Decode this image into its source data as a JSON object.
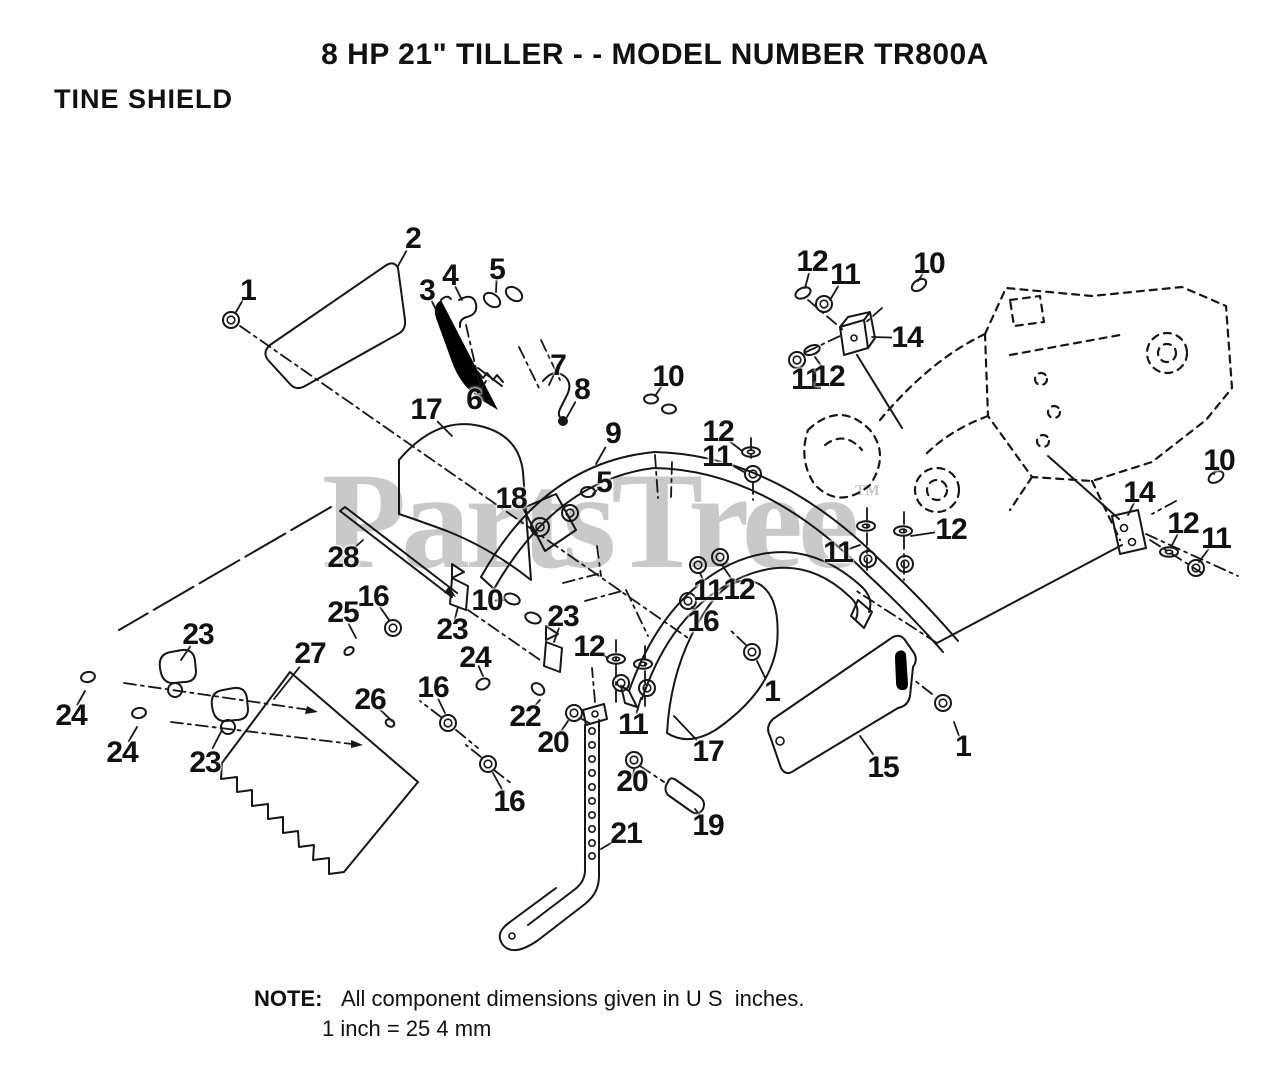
{
  "page": {
    "title": "8 HP 21\" TILLER - - MODEL NUMBER TR800A",
    "section": "TINE SHIELD",
    "note": {
      "label": "NOTE:",
      "line1": "All component dimensions given in U S  inches.",
      "line2": "1 inch = 25 4 mm"
    },
    "watermark": {
      "text": "PartsTree",
      "tm": "™",
      "color": "#c9c9c9"
    }
  },
  "diagram": {
    "ink": "#161616",
    "description": "Exploded parts view of tine shield assembly with numbered callouts",
    "callouts": [
      {
        "label": "1",
        "x": 248,
        "y": 291,
        "tx": 236,
        "ty": 312
      },
      {
        "label": "2",
        "x": 413,
        "y": 239,
        "tx": 398,
        "ty": 266
      },
      {
        "label": "3",
        "x": 427,
        "y": 291,
        "tx": 438,
        "ty": 314
      },
      {
        "label": "4",
        "x": 450,
        "y": 276,
        "tx": 462,
        "ty": 300
      },
      {
        "label": "5",
        "x": 497,
        "y": 270,
        "tx": 496,
        "ty": 292
      },
      {
        "label": "6",
        "x": 474,
        "y": 400,
        "tx": 486,
        "ty": 381
      },
      {
        "label": "7",
        "x": 558,
        "y": 366,
        "tx": 549,
        "ty": 385
      },
      {
        "label": "8",
        "x": 582,
        "y": 390,
        "tx": 567,
        "ty": 417
      },
      {
        "label": "9",
        "x": 613,
        "y": 434,
        "tx": 596,
        "ty": 464
      },
      {
        "label": "10",
        "x": 668,
        "y": 377,
        "tx": 655,
        "ty": 396
      },
      {
        "label": "12",
        "x": 718,
        "y": 432,
        "tx": 742,
        "ty": 451
      },
      {
        "label": "11",
        "x": 717,
        "y": 457,
        "tx": 744,
        "ty": 472
      },
      {
        "label": "18",
        "x": 511,
        "y": 499,
        "tx": 528,
        "ty": 513
      },
      {
        "label": "5",
        "x": 604,
        "y": 483,
        "tx": 593,
        "ty": 494
      },
      {
        "label": "28",
        "x": 343,
        "y": 558,
        "tx": 363,
        "ty": 540
      },
      {
        "label": "12",
        "x": 812,
        "y": 262,
        "tx": 805,
        "ty": 288
      },
      {
        "label": "11",
        "x": 845,
        "y": 275,
        "tx": 830,
        "ty": 300
      },
      {
        "label": "10",
        "x": 929,
        "y": 264,
        "tx": 918,
        "ty": 281
      },
      {
        "label": "14",
        "x": 907,
        "y": 338,
        "tx": 872,
        "ty": 337
      },
      {
        "label": "11",
        "x": 806,
        "y": 380,
        "tx": 798,
        "ty": 368
      },
      {
        "label": "12",
        "x": 829,
        "y": 377,
        "tx": 815,
        "ty": 357
      },
      {
        "label": "10",
        "x": 1219,
        "y": 461,
        "tx": 1214,
        "ty": 474
      },
      {
        "label": "14",
        "x": 1139,
        "y": 493,
        "tx": 1128,
        "ty": 515
      },
      {
        "label": "12",
        "x": 1183,
        "y": 524,
        "tx": 1171,
        "ty": 547
      },
      {
        "label": "11",
        "x": 1216,
        "y": 539,
        "tx": 1199,
        "ty": 562
      },
      {
        "label": "12",
        "x": 951,
        "y": 530,
        "tx": 911,
        "ty": 536
      },
      {
        "label": "11",
        "x": 838,
        "y": 553,
        "tx": 860,
        "ty": 545
      },
      {
        "label": "11",
        "x": 708,
        "y": 591,
        "tx": 700,
        "ty": 573
      },
      {
        "label": "12",
        "x": 739,
        "y": 590,
        "tx": 722,
        "ty": 565
      },
      {
        "label": "16",
        "x": 703,
        "y": 622,
        "tx": 692,
        "ty": 607
      },
      {
        "label": "1",
        "x": 772,
        "y": 692,
        "tx": 757,
        "ty": 661
      },
      {
        "label": "17",
        "x": 708,
        "y": 752,
        "tx": 674,
        "ty": 716
      },
      {
        "label": "15",
        "x": 883,
        "y": 768,
        "tx": 860,
        "ty": 736
      },
      {
        "label": "1",
        "x": 963,
        "y": 747,
        "tx": 954,
        "ty": 722
      },
      {
        "label": "16",
        "x": 373,
        "y": 597,
        "tx": 389,
        "ty": 620
      },
      {
        "label": "25",
        "x": 343,
        "y": 613,
        "tx": 356,
        "ty": 638
      },
      {
        "label": "23",
        "x": 452,
        "y": 630,
        "tx": 458,
        "ty": 607
      },
      {
        "label": "10",
        "x": 487,
        "y": 601,
        "tx": 506,
        "ty": 600
      },
      {
        "label": "23",
        "x": 563,
        "y": 617,
        "tx": 554,
        "ty": 642
      },
      {
        "label": "12",
        "x": 589,
        "y": 647,
        "tx": 608,
        "ty": 658
      },
      {
        "label": "24",
        "x": 475,
        "y": 658,
        "tx": 483,
        "ty": 676
      },
      {
        "label": "26",
        "x": 370,
        "y": 700,
        "tx": 392,
        "ty": 721
      },
      {
        "label": "16",
        "x": 433,
        "y": 688,
        "tx": 445,
        "ty": 713
      },
      {
        "label": "22",
        "x": 525,
        "y": 717,
        "tx": 540,
        "ty": 700
      },
      {
        "label": "20",
        "x": 553,
        "y": 743,
        "tx": 568,
        "ty": 721
      },
      {
        "label": "11",
        "x": 633,
        "y": 725,
        "tx": 641,
        "ty": 698
      },
      {
        "label": "20",
        "x": 632,
        "y": 782,
        "tx": 634,
        "ty": 769
      },
      {
        "label": "16",
        "x": 509,
        "y": 802,
        "tx": 493,
        "ty": 773
      },
      {
        "label": "21",
        "x": 626,
        "y": 834,
        "tx": 601,
        "ty": 849
      },
      {
        "label": "19",
        "x": 708,
        "y": 826,
        "tx": 695,
        "ty": 809
      },
      {
        "label": "17",
        "x": 426,
        "y": 410,
        "tx": 452,
        "ty": 436
      },
      {
        "label": "23",
        "x": 198,
        "y": 635,
        "tx": 181,
        "ty": 660
      },
      {
        "label": "24",
        "x": 71,
        "y": 716,
        "tx": 85,
        "ty": 691
      },
      {
        "label": "24",
        "x": 122,
        "y": 753,
        "tx": 137,
        "ty": 727
      },
      {
        "label": "23",
        "x": 205,
        "y": 763,
        "tx": 222,
        "ty": 730
      },
      {
        "label": "27",
        "x": 310,
        "y": 654,
        "tx": 274,
        "ty": 699
      }
    ]
  }
}
